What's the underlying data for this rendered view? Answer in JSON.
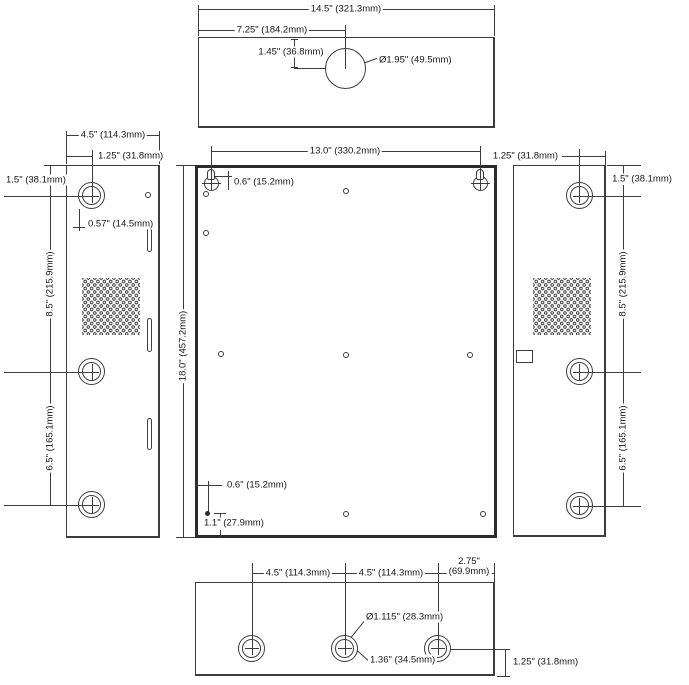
{
  "views": {
    "top": {
      "width": "14.5\" (321.3mm)",
      "center_offset": "7.25\" (184.2mm)",
      "hole_drop": "1.45\" (36.8mm)",
      "hole_diameter": "Ø1.95\" (49.5mm)"
    },
    "left": {
      "depth": "4.5\" (114.3mm)",
      "knockout_inset": "1.25\" (31.8mm)",
      "knockout_drop": "1.5\" (38.1mm)",
      "knockout_radius": "0.57\" (14.5mm)",
      "knockout_spacing_upper": "8.5\" (215.9mm)",
      "knockout_spacing_lower": "6.5\" (165.1mm)"
    },
    "front": {
      "mount_width": "13.0\" (330.2mm)",
      "height": "18.0\" (457.2mm)",
      "mount_drop": "0.6\" (15.2mm)",
      "corner_inset": "0.6\" (15.2mm)",
      "corner_rise": "1.1\" (27.9mm)"
    },
    "right": {
      "knockout_inset": "1.25\" (31.8mm)",
      "knockout_drop": "1.5\" (38.1mm)",
      "knockout_spacing_upper": "8.5\" (215.9mm)",
      "knockout_spacing_lower": "6.5\" (165.1mm)"
    },
    "bottom": {
      "knockout_spacing_left": "4.5\" (114.3mm)",
      "knockout_spacing_right": "4.5\" (114.3mm)",
      "edge_offset_in": "2.75\"",
      "edge_offset_mm": "(69.9mm)",
      "knockout_diameter": "Ø1.115\" (28.3mm)",
      "knockout_size": "1.36\" (34.5mm)",
      "knockout_rise": "1.25\" (31.8mm)"
    }
  }
}
